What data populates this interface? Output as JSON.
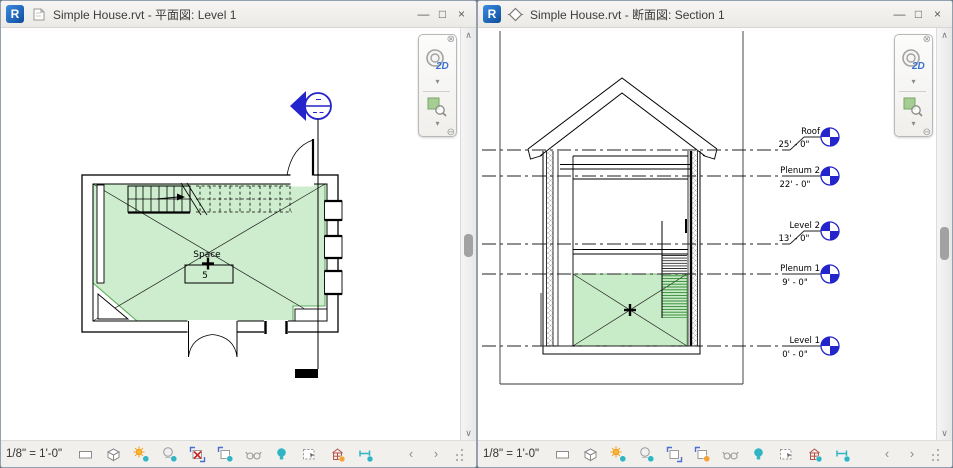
{
  "left_window": {
    "title": "Simple House.rvt - 平面図: Level 1",
    "view_type": "floor-plan",
    "controls": {
      "minimize": "—",
      "maximize": "□",
      "close": "×"
    },
    "navbar": {
      "wheel_label": "2D"
    },
    "plan": {
      "space_label": "Space",
      "space_number": "5"
    },
    "view_bar": {
      "scale": "1/8\" = 1'-0\"",
      "prev": "‹",
      "next": "›"
    },
    "scroll": {
      "up": "∧",
      "down": "∨"
    }
  },
  "right_window": {
    "title": "Simple House.rvt - 断面図: Section 1",
    "view_type": "section",
    "controls": {
      "minimize": "—",
      "maximize": "□",
      "close": "×"
    },
    "navbar": {
      "wheel_label": "2D"
    },
    "view_bar": {
      "scale": "1/8\" = 1'-0\"",
      "prev": "‹",
      "next": "›"
    },
    "scroll": {
      "up": "∧",
      "down": "∨"
    },
    "levels": [
      {
        "name": "Roof",
        "elevation": "25' - 0\""
      },
      {
        "name": "Plenum 2",
        "elevation": "22' - 0\""
      },
      {
        "name": "Level 2",
        "elevation": "13' - 0\""
      },
      {
        "name": "Plenum 1",
        "elevation": "9' - 0\""
      },
      {
        "name": "Level 1",
        "elevation": "0' - 0\""
      }
    ]
  },
  "view_control_bar_icons": [
    "detail-level",
    "visual-style",
    "sun-path",
    "shadows",
    "crop-view",
    "show-crop-region",
    "temporary-hide-isolate",
    "reveal-hidden-elements",
    "temporary-view-properties",
    "analytical-model",
    "reveal-constraints"
  ],
  "colors": {
    "accent_teal": "#31b5c4",
    "accent_orange": "#f2a33a",
    "revit_blue": "#1464b4",
    "annotation_blue": "#2424cc",
    "space_green": "#92d792",
    "error_red": "#c92a2a"
  }
}
